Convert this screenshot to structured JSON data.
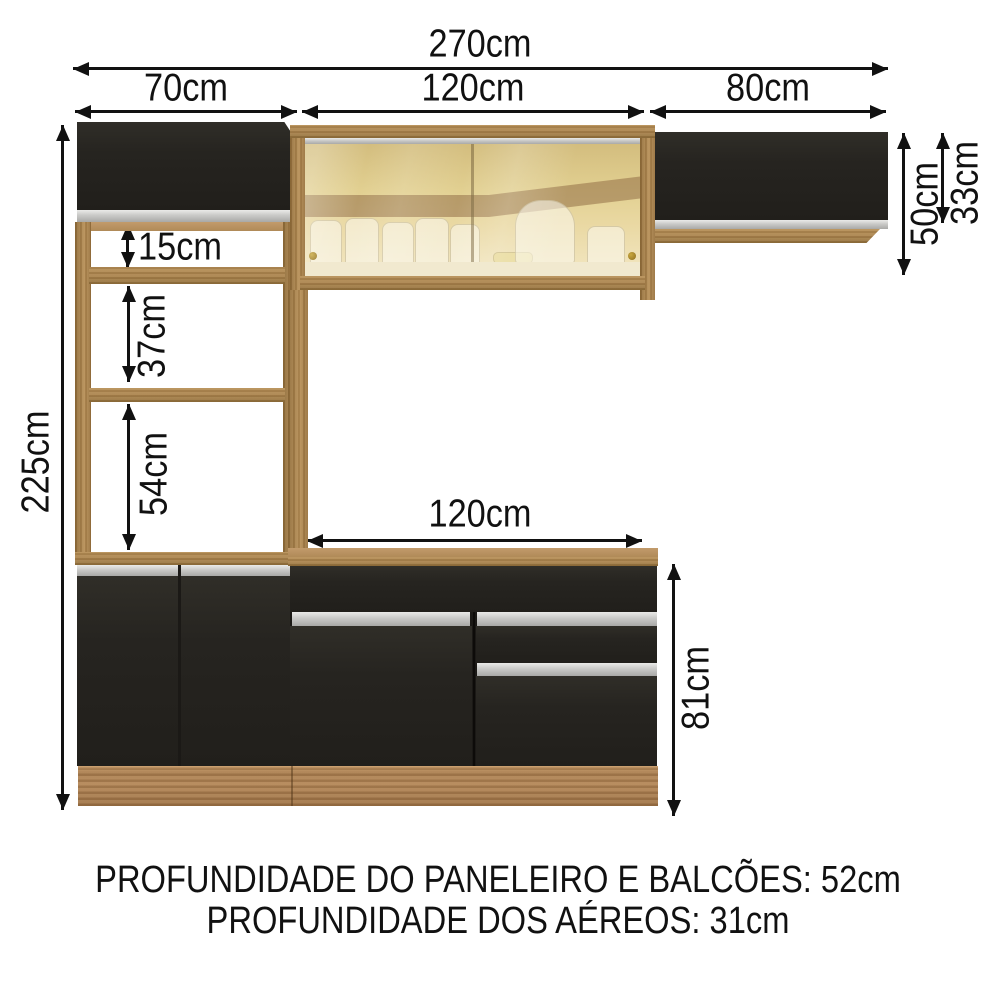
{
  "dimensions": {
    "total_width": "270cm",
    "left_section_width": "70cm",
    "middle_section_width": "120cm",
    "right_section_width": "80cm",
    "total_height": "225cm",
    "niche_top_height": "15cm",
    "niche_middle_height": "37cm",
    "niche_bottom_height": "54cm",
    "counter_width": "120cm",
    "counter_height": "81cm",
    "glass_cabinet_height": "50cm",
    "right_cabinet_height": "33cm"
  },
  "footer": {
    "line1": "PROFUNDIDADE DO PANELEIRO E BALCÕES: 52cm",
    "line2": "PROFUNDIDADE DOS AÉREOS: 31cm"
  },
  "colors": {
    "background": "#ffffff",
    "arrow": "#111111",
    "text": "#111111",
    "cabinet_black": "#262420",
    "cabinet_black_dark": "#1b1916",
    "silver": "#c9c9c7",
    "wood": "#a8824d",
    "wood_light": "#c29b6b",
    "plinth": "#b08457",
    "glass": "#e2d091",
    "knob_gold": "#8d6d20"
  }
}
